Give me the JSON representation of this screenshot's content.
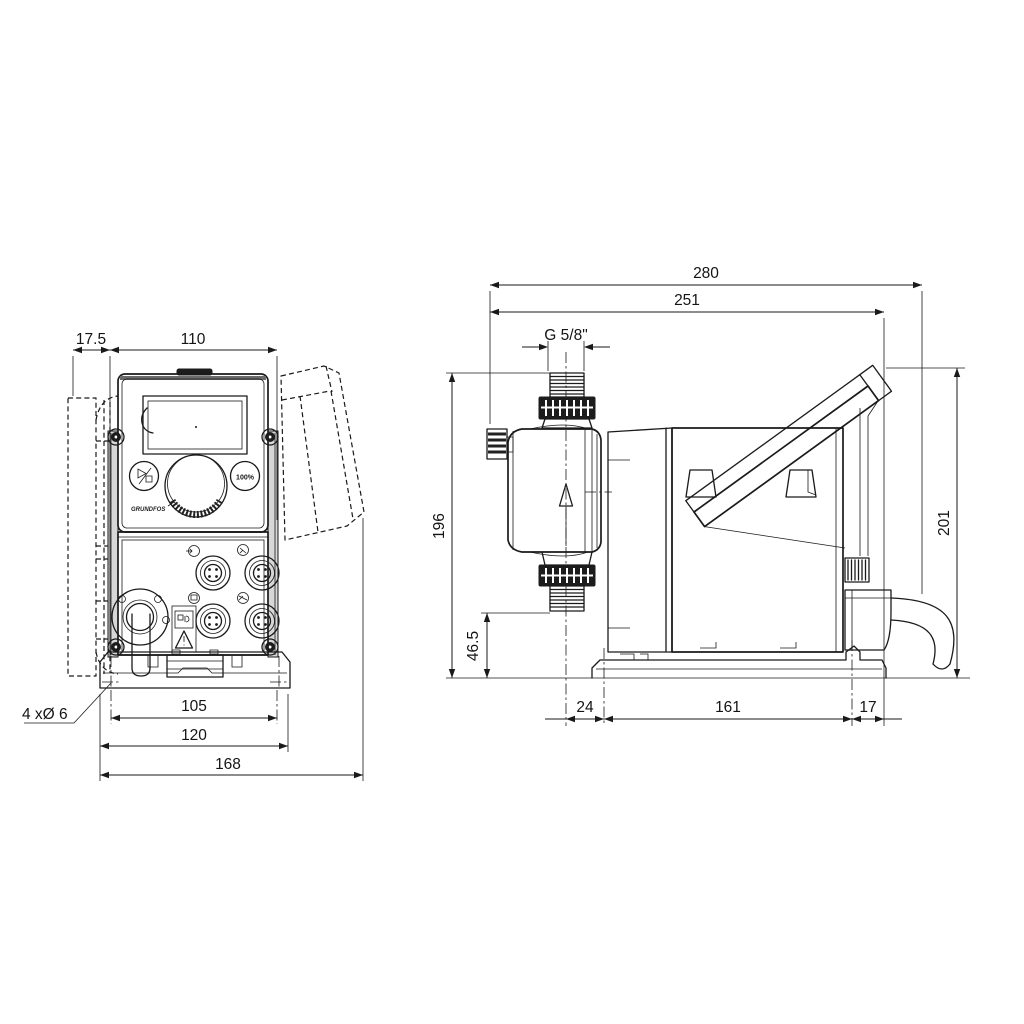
{
  "drawing": {
    "background": "#ffffff",
    "line_color": "#1a1a1a",
    "front_view": {
      "dim_bracket_offset": "17.5",
      "dim_body_width": "110",
      "dim_hole_spacing": "105",
      "dim_plate_width": "120",
      "dim_total_width": "168",
      "note_mounting_holes": "4 xØ 6",
      "button_percent": "100%",
      "logo_text": "GRUNDFOS"
    },
    "side_view": {
      "dim_total_depth": "280",
      "dim_depth_to_panel": "251",
      "dim_thread": "G 5/8\"",
      "dim_height_to_connection": "196",
      "dim_suction_height": "46.5",
      "dim_height_to_panel": "201",
      "dim_front_overhang": "24",
      "dim_base_hole_spacing": "161",
      "dim_rear_overhang": "17"
    }
  }
}
